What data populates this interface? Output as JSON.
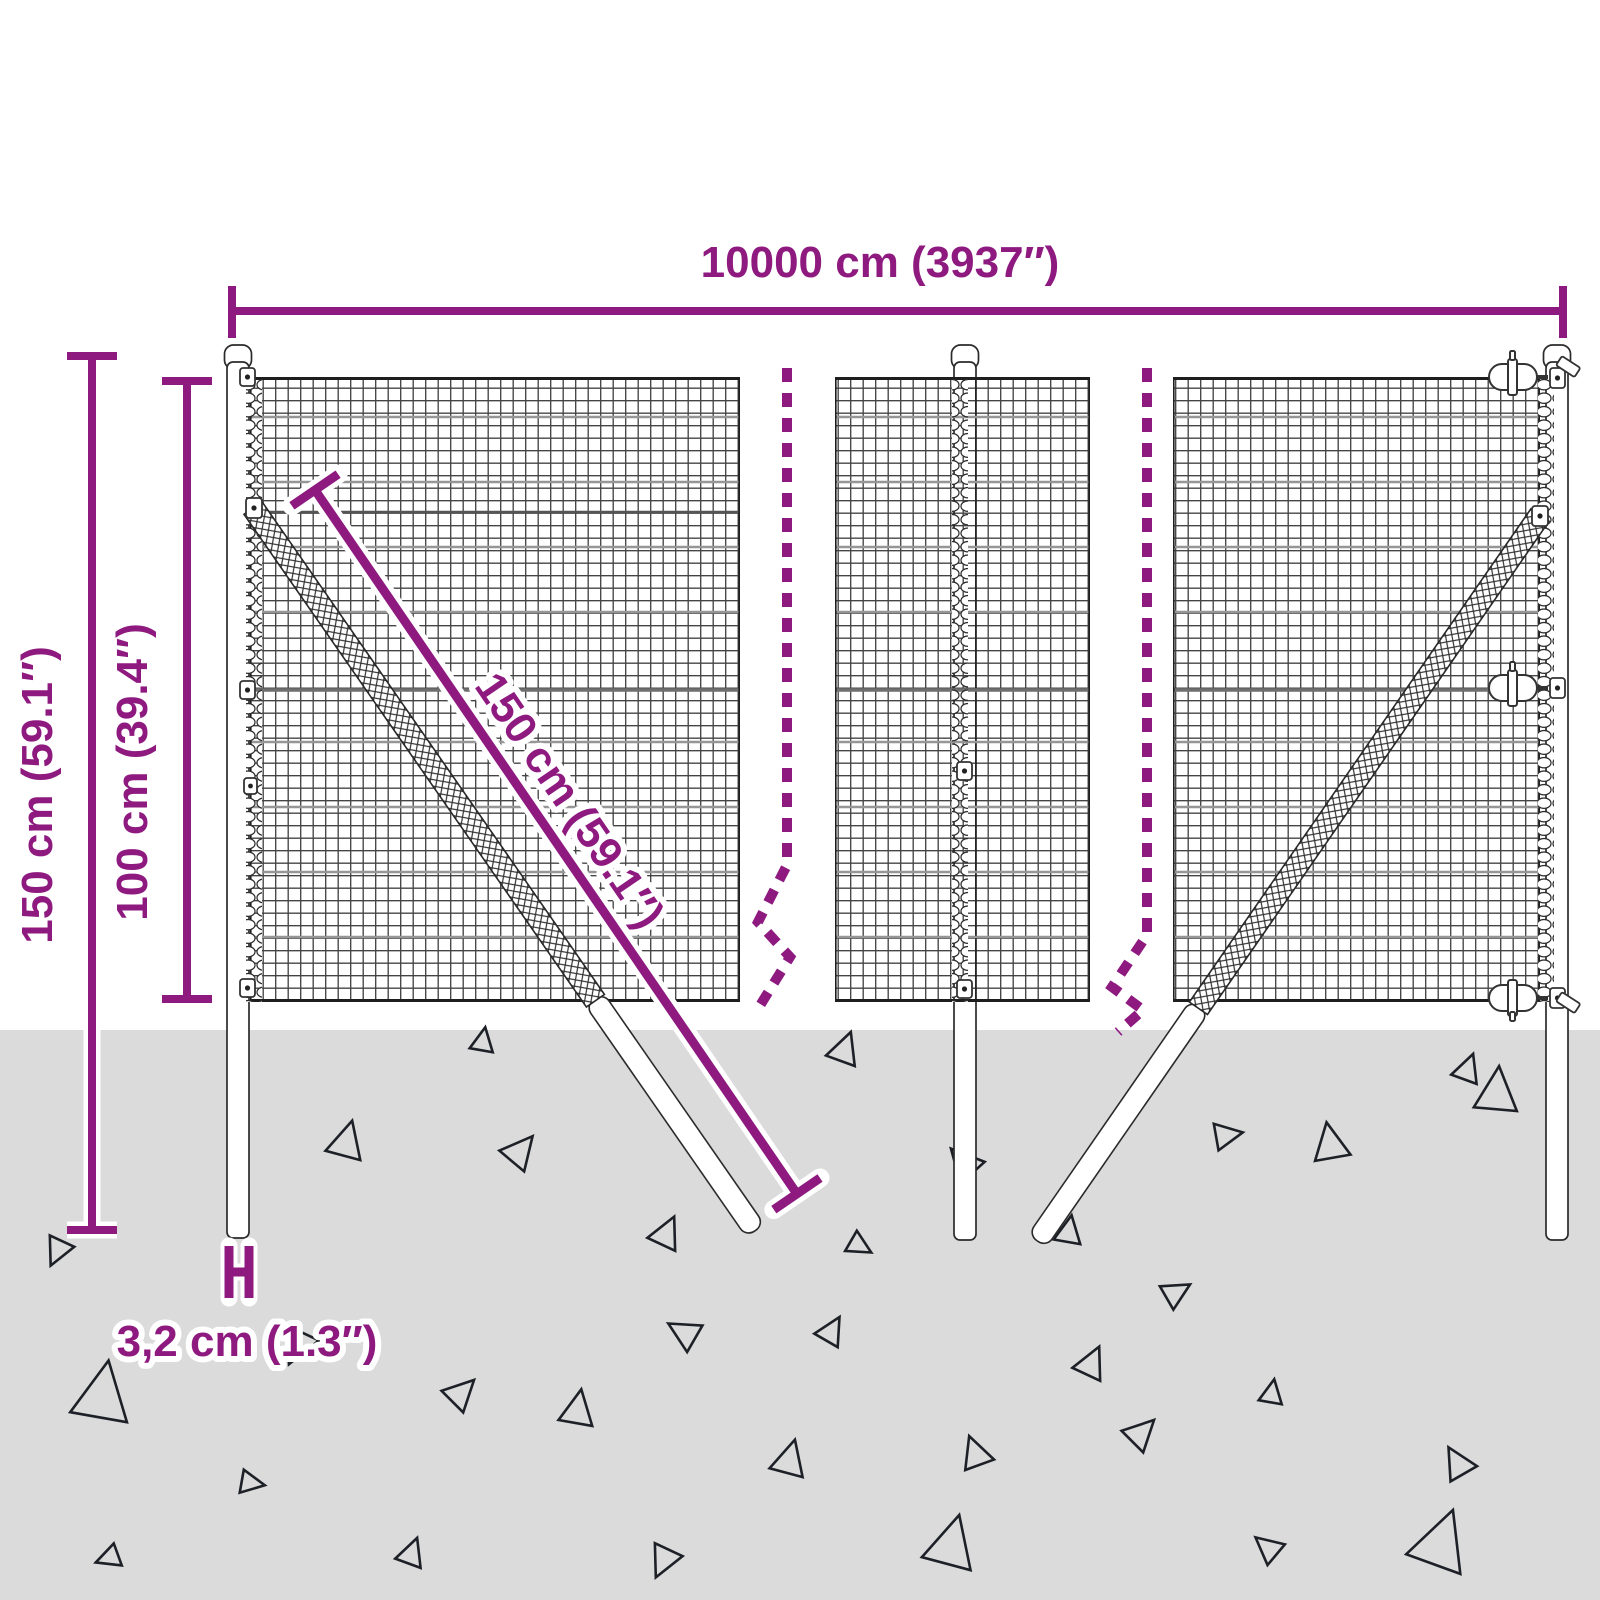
{
  "diagram": {
    "type": "product-dimension-diagram",
    "subject": "wire mesh fence with posts and braces",
    "colors": {
      "accent": "#8E1A80",
      "ground": "#DBDBDB",
      "mesh_line": "#1B1B1B",
      "wire_gray": "#969696",
      "outline": "#2B2B2B",
      "triangle_stroke": "#1D2127"
    },
    "dimensions": {
      "total_width": {
        "label": "10000 cm (3937″)"
      },
      "total_height": {
        "label": "150 cm (59.1″)"
      },
      "mesh_height": {
        "label": "100 cm (39.4″)"
      },
      "brace_length": {
        "label": "150 cm (59.1″)"
      },
      "post_width": {
        "label": "3,2 cm (1.3″)"
      }
    }
  }
}
